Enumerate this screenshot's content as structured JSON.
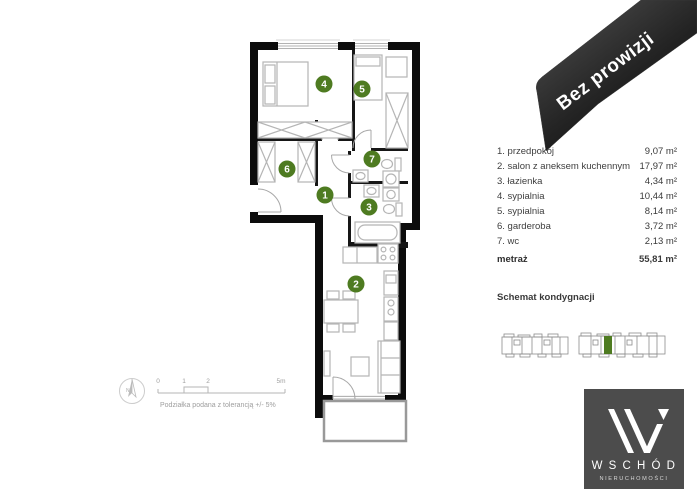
{
  "banner": {
    "label": "Bez prowizji"
  },
  "legend": {
    "rows": [
      {
        "label": "1. przedpokój",
        "value": "9,07 m²"
      },
      {
        "label": "2. salon z aneksem kuchennym",
        "value": "17,97 m²"
      },
      {
        "label": "3. łazienka",
        "value": "4,34 m²"
      },
      {
        "label": "4. sypialnia",
        "value": "10,44 m²"
      },
      {
        "label": "5. sypialnia",
        "value": "8,14 m²"
      },
      {
        "label": "6. garderoba",
        "value": "3,72 m²"
      },
      {
        "label": "7. wc",
        "value": "2,13 m²"
      }
    ],
    "total_label": "metraż",
    "total_value": "55,81 m²"
  },
  "floor_schematic": {
    "title": "Schemat kondygnacji"
  },
  "scale_bar": {
    "ticks": [
      "0",
      "1",
      "2",
      "5m"
    ],
    "disclaimer": "Podziałka podana z tolerancją +/- 5%",
    "compass_label": "N"
  },
  "floorplan": {
    "rooms": [
      {
        "number": "1",
        "name": "przedpokój"
      },
      {
        "number": "2",
        "name": "salon z aneksem kuchennym"
      },
      {
        "number": "3",
        "name": "łazienka"
      },
      {
        "number": "4",
        "name": "sypialnia"
      },
      {
        "number": "5",
        "name": "sypialnia"
      },
      {
        "number": "6",
        "name": "garderoba"
      },
      {
        "number": "7",
        "name": "wc"
      }
    ]
  },
  "logo": {
    "name": "W S C H Ó D",
    "subtitle": "NIERUCHOMOŚCI"
  },
  "colors": {
    "accent_green": "#4e7b21",
    "wall_black": "#0c0c0c",
    "banner_dark": "#1c1c1c",
    "logo_gray": "#4c4c4c"
  }
}
